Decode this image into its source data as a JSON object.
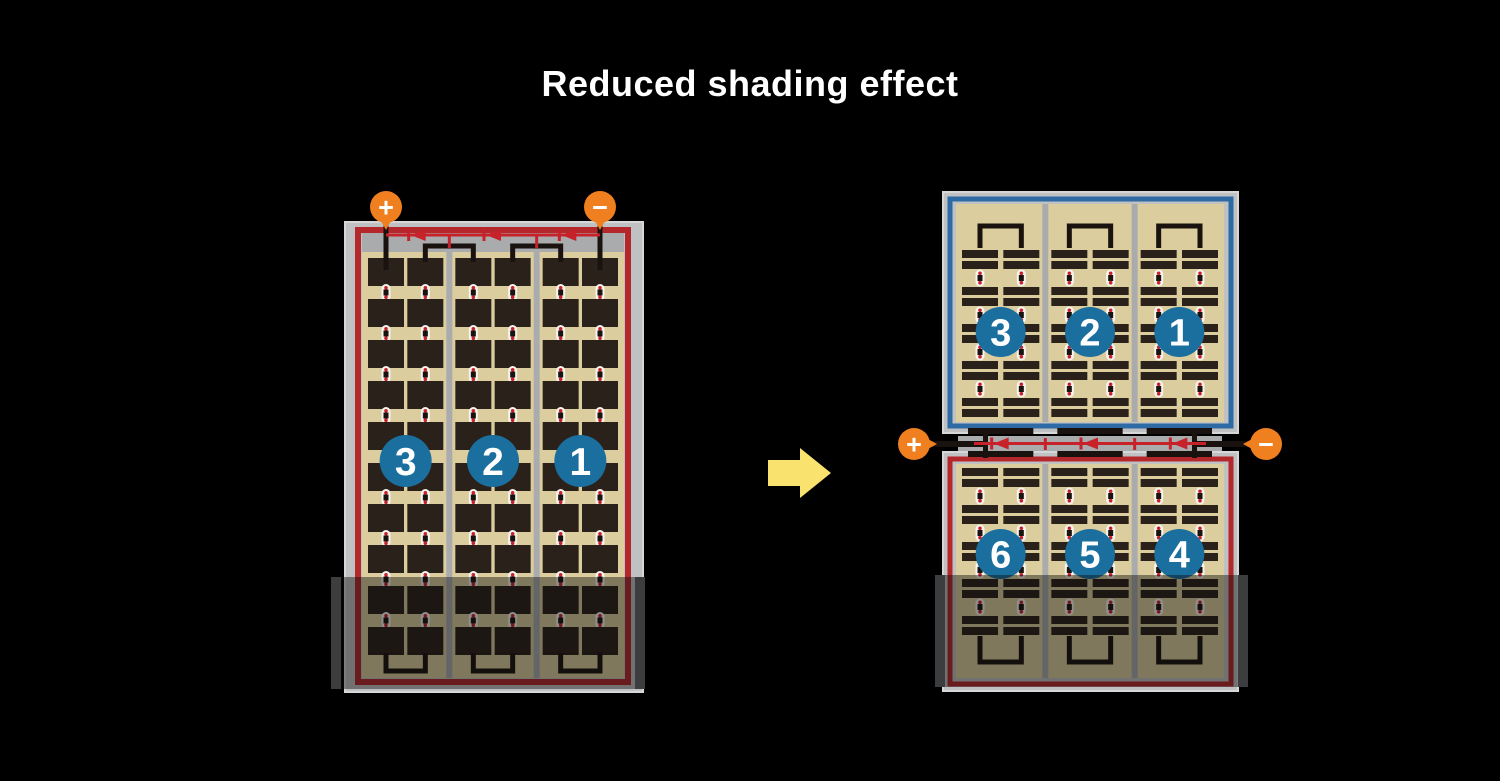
{
  "title": "Reduced shading effect",
  "panels": {
    "single": {
      "strings": [
        "3",
        "2",
        "1"
      ],
      "terminal_positive": "+",
      "terminal_negative": "−",
      "diode_count": 3,
      "shaded_area": "bottom"
    },
    "split": {
      "top_strings": [
        "3",
        "2",
        "1"
      ],
      "bottom_strings": [
        "6",
        "5",
        "4"
      ],
      "terminal_positive": "+",
      "terminal_negative": "−",
      "diode_count": 3,
      "shaded_area": "bottom"
    }
  },
  "arrow": {
    "direction": "right"
  },
  "colors": {
    "background": "#000000",
    "title_text": "#ffffff",
    "panel_frame": "#c0c1c3",
    "panel_frame_edge": "#d6d7d8",
    "junction_gray": "#a9abad",
    "cell_background": "#dbcd9e",
    "cell_dark": "#2b211b",
    "red_border": "#b4282b",
    "blue_border": "#2e6ba4",
    "diode_red": "#c7222a",
    "wire_black": "#1a120e",
    "terminal_orange": "#ef7f1f",
    "string_circle_blue": "#1a6f9e",
    "string_circle_text": "#ffffff",
    "arrow_yellow": "#f9e26e",
    "connector_white": "#f6f4ef",
    "shade_edge": "#3c3d3f"
  }
}
